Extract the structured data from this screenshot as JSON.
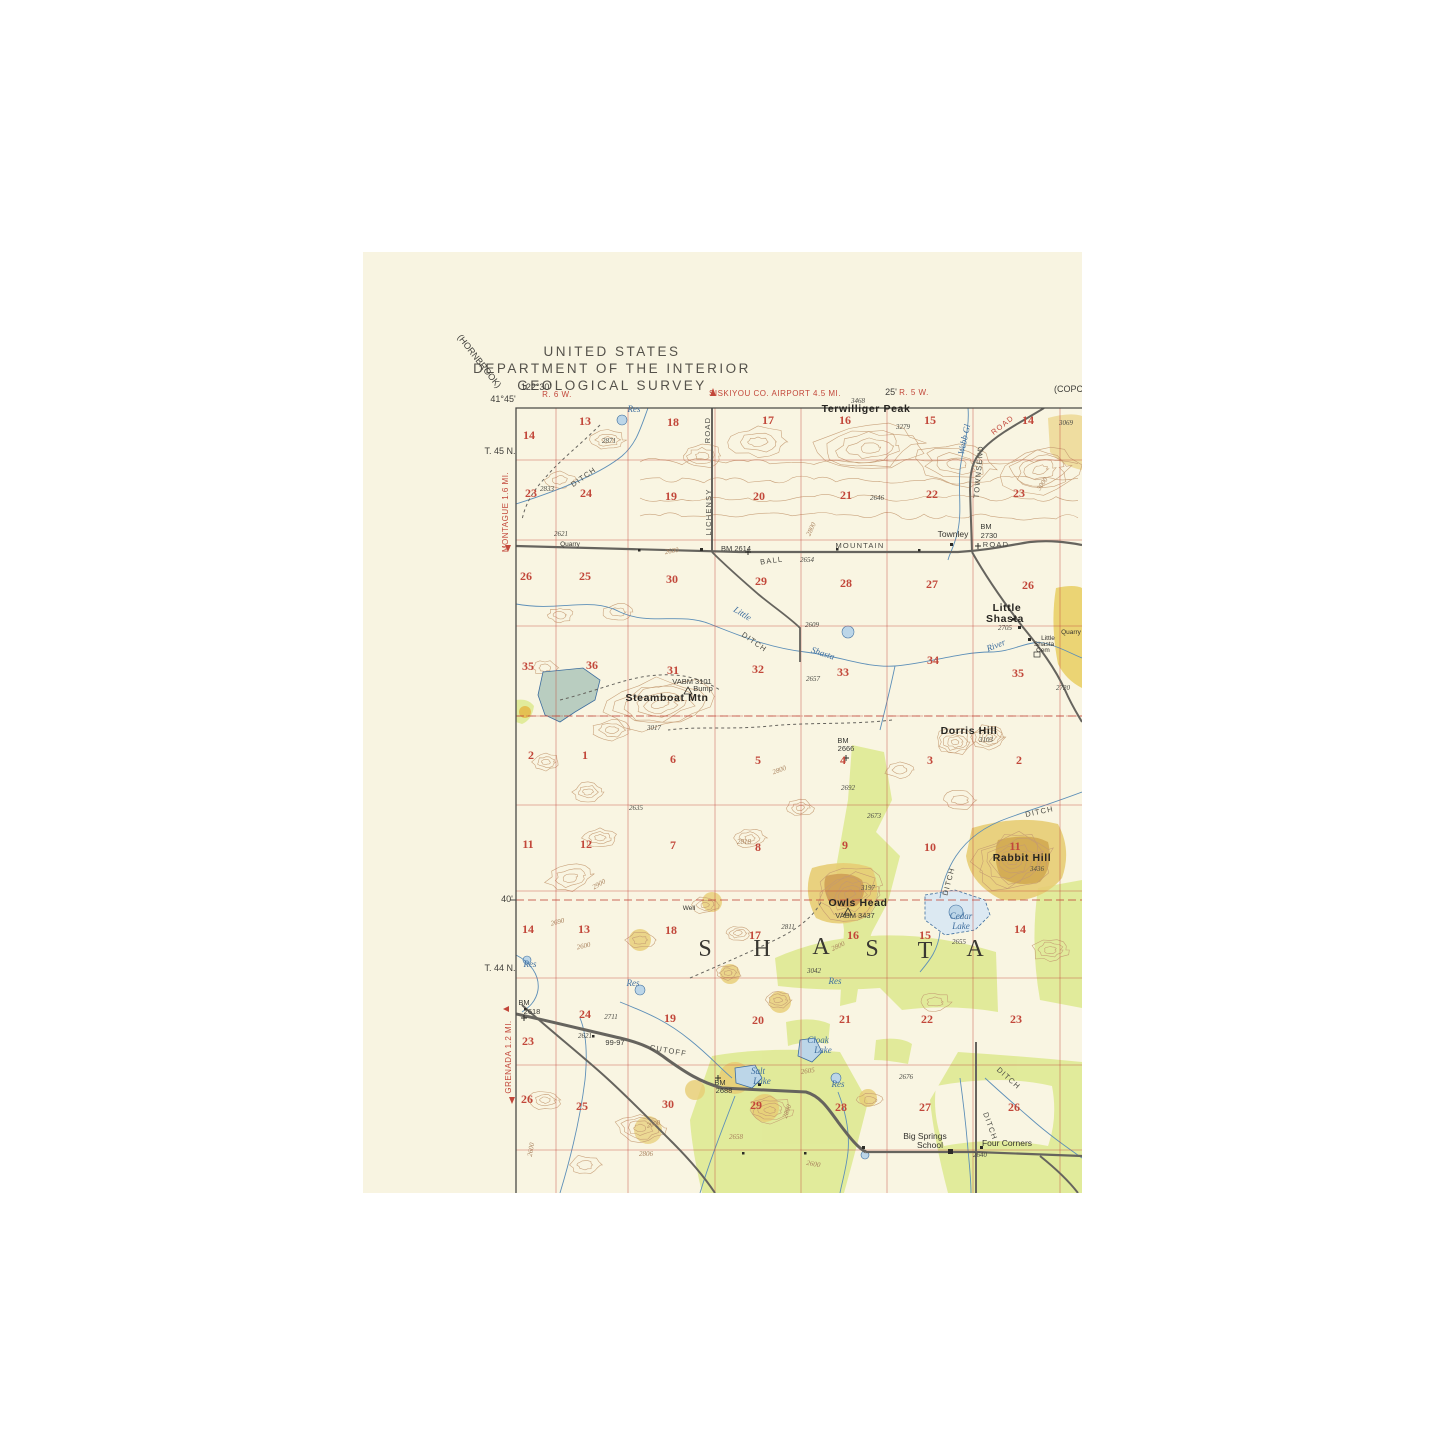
{
  "header": {
    "line1": "UNITED STATES",
    "line2": "DEPARTMENT OF THE INTERIOR",
    "line3": "GEOLOGICAL SURVEY"
  },
  "colors": {
    "paper": "#f8f4e1",
    "map_ground": "#f9f5e2",
    "grid_red": "#c2473a",
    "water_blue": "#3d6d9e",
    "water_fill": "#c9dfea",
    "reservoir_fill": "#b9cdc0",
    "contour_brown": "#c49a72",
    "vegetation_green": "#dde98e",
    "hill_tan": "#e7cd74",
    "hill_tan_dark": "#d2a951",
    "road_gray": "#66645e",
    "text_black": "#35332e"
  },
  "map": {
    "labels": [
      {
        "t": "(HORNBROOK)",
        "x": 477,
        "y": 363,
        "c": "e",
        "r": 52
      },
      {
        "t": "122°30'",
        "x": 536,
        "y": 390,
        "c": "e"
      },
      {
        "t": "41°45'",
        "x": 503,
        "y": 402,
        "c": "e"
      },
      {
        "t": "R. 6 W.",
        "x": 557,
        "y": 397,
        "c": "er"
      },
      {
        "t": "SISKIYOU CO. AIRPORT 4.5 MI.",
        "x": 775,
        "y": 396,
        "c": "er"
      },
      {
        "t": "25'",
        "x": 891,
        "y": 395,
        "c": "e"
      },
      {
        "t": "R. 5 W.",
        "x": 914,
        "y": 395,
        "c": "er"
      },
      {
        "t": "(COPCO",
        "x": 1072,
        "y": 392,
        "c": "e"
      },
      {
        "t": "T. 45 N.",
        "x": 500,
        "y": 454,
        "c": "e"
      },
      {
        "t": "MONTAGUE 1.6 MI.",
        "x": 508,
        "y": 512,
        "c": "er",
        "r": -90
      },
      {
        "t": "40'",
        "x": 507,
        "y": 902,
        "c": "e"
      },
      {
        "t": "T. 44 N.",
        "x": 500,
        "y": 971,
        "c": "e"
      },
      {
        "t": "GRENADA 1.2 MI.",
        "x": 511,
        "y": 1057,
        "c": "er",
        "r": -90
      },
      {
        "t": "14",
        "x": 529,
        "y": 439,
        "c": "s"
      },
      {
        "t": "13",
        "x": 585,
        "y": 425,
        "c": "s"
      },
      {
        "t": "18",
        "x": 673,
        "y": 426,
        "c": "s"
      },
      {
        "t": "17",
        "x": 768,
        "y": 424,
        "c": "s"
      },
      {
        "t": "16",
        "x": 845,
        "y": 424,
        "c": "s"
      },
      {
        "t": "15",
        "x": 930,
        "y": 424,
        "c": "s"
      },
      {
        "t": "14",
        "x": 1028,
        "y": 424,
        "c": "s"
      },
      {
        "t": "23",
        "x": 531,
        "y": 497,
        "c": "s"
      },
      {
        "t": "24",
        "x": 586,
        "y": 497,
        "c": "s"
      },
      {
        "t": "19",
        "x": 671,
        "y": 500,
        "c": "s"
      },
      {
        "t": "20",
        "x": 759,
        "y": 500,
        "c": "s"
      },
      {
        "t": "21",
        "x": 846,
        "y": 499,
        "c": "s"
      },
      {
        "t": "22",
        "x": 932,
        "y": 498,
        "c": "s"
      },
      {
        "t": "23",
        "x": 1019,
        "y": 497,
        "c": "s"
      },
      {
        "t": "26",
        "x": 526,
        "y": 580,
        "c": "s"
      },
      {
        "t": "25",
        "x": 585,
        "y": 580,
        "c": "s"
      },
      {
        "t": "30",
        "x": 672,
        "y": 583,
        "c": "s"
      },
      {
        "t": "29",
        "x": 761,
        "y": 585,
        "c": "s"
      },
      {
        "t": "28",
        "x": 846,
        "y": 587,
        "c": "s"
      },
      {
        "t": "27",
        "x": 932,
        "y": 588,
        "c": "s"
      },
      {
        "t": "26",
        "x": 1028,
        "y": 589,
        "c": "s"
      },
      {
        "t": "35",
        "x": 528,
        "y": 670,
        "c": "s"
      },
      {
        "t": "36",
        "x": 592,
        "y": 669,
        "c": "s"
      },
      {
        "t": "31",
        "x": 673,
        "y": 674,
        "c": "s"
      },
      {
        "t": "32",
        "x": 758,
        "y": 673,
        "c": "s"
      },
      {
        "t": "33",
        "x": 843,
        "y": 676,
        "c": "s"
      },
      {
        "t": "34",
        "x": 933,
        "y": 664,
        "c": "s"
      },
      {
        "t": "35",
        "x": 1018,
        "y": 677,
        "c": "s"
      },
      {
        "t": "2",
        "x": 531,
        "y": 759,
        "c": "s"
      },
      {
        "t": "1",
        "x": 585,
        "y": 759,
        "c": "s"
      },
      {
        "t": "6",
        "x": 673,
        "y": 763,
        "c": "s"
      },
      {
        "t": "5",
        "x": 758,
        "y": 764,
        "c": "s"
      },
      {
        "t": "4",
        "x": 843,
        "y": 764,
        "c": "s"
      },
      {
        "t": "3",
        "x": 930,
        "y": 764,
        "c": "s"
      },
      {
        "t": "2",
        "x": 1019,
        "y": 764,
        "c": "s"
      },
      {
        "t": "11",
        "x": 528,
        "y": 848,
        "c": "s"
      },
      {
        "t": "12",
        "x": 586,
        "y": 848,
        "c": "s"
      },
      {
        "t": "7",
        "x": 673,
        "y": 849,
        "c": "s"
      },
      {
        "t": "8",
        "x": 758,
        "y": 851,
        "c": "s"
      },
      {
        "t": "9",
        "x": 845,
        "y": 849,
        "c": "s"
      },
      {
        "t": "10",
        "x": 930,
        "y": 851,
        "c": "s"
      },
      {
        "t": "11",
        "x": 1015,
        "y": 850,
        "c": "s"
      },
      {
        "t": "14",
        "x": 528,
        "y": 933,
        "c": "s"
      },
      {
        "t": "13",
        "x": 584,
        "y": 933,
        "c": "s"
      },
      {
        "t": "18",
        "x": 671,
        "y": 934,
        "c": "s"
      },
      {
        "t": "17",
        "x": 755,
        "y": 939,
        "c": "s"
      },
      {
        "t": "16",
        "x": 853,
        "y": 939,
        "c": "s"
      },
      {
        "t": "15",
        "x": 925,
        "y": 939,
        "c": "s"
      },
      {
        "t": "14",
        "x": 1020,
        "y": 933,
        "c": "s"
      },
      {
        "t": "23",
        "x": 528,
        "y": 1045,
        "c": "s"
      },
      {
        "t": "24",
        "x": 585,
        "y": 1018,
        "c": "s"
      },
      {
        "t": "19",
        "x": 670,
        "y": 1022,
        "c": "s"
      },
      {
        "t": "20",
        "x": 758,
        "y": 1024,
        "c": "s"
      },
      {
        "t": "21",
        "x": 845,
        "y": 1023,
        "c": "s"
      },
      {
        "t": "22",
        "x": 927,
        "y": 1023,
        "c": "s"
      },
      {
        "t": "23",
        "x": 1016,
        "y": 1023,
        "c": "s"
      },
      {
        "t": "26",
        "x": 527,
        "y": 1103,
        "c": "s"
      },
      {
        "t": "25",
        "x": 582,
        "y": 1110,
        "c": "s"
      },
      {
        "t": "30",
        "x": 668,
        "y": 1108,
        "c": "s"
      },
      {
        "t": "29",
        "x": 756,
        "y": 1109,
        "c": "s"
      },
      {
        "t": "28",
        "x": 841,
        "y": 1111,
        "c": "s"
      },
      {
        "t": "27",
        "x": 925,
        "y": 1111,
        "c": "s"
      },
      {
        "t": "26",
        "x": 1014,
        "y": 1111,
        "c": "s"
      },
      {
        "t": "Terwilliger Peak",
        "x": 866,
        "y": 412,
        "c": "pb"
      },
      {
        "t": "3468",
        "x": 858,
        "y": 403,
        "c": "vi"
      },
      {
        "t": "3279",
        "x": 903,
        "y": 429,
        "c": "vi"
      },
      {
        "t": "3069",
        "x": 1066,
        "y": 425,
        "c": "vi"
      },
      {
        "t": "Res",
        "x": 634,
        "y": 412,
        "c": "w"
      },
      {
        "t": "2871",
        "x": 609,
        "y": 443,
        "c": "vi"
      },
      {
        "t": "2833",
        "x": 547,
        "y": 491,
        "c": "vi"
      },
      {
        "t": "DITCH",
        "x": 585,
        "y": 479,
        "c": "rd",
        "r": -35
      },
      {
        "t": "2646",
        "x": 877,
        "y": 500,
        "c": "vi"
      },
      {
        "t": "Townley",
        "x": 953,
        "y": 537,
        "c": "p"
      },
      {
        "t": "BM",
        "x": 986,
        "y": 529,
        "c": "v"
      },
      {
        "t": "2730",
        "x": 989,
        "y": 538,
        "c": "v"
      },
      {
        "t": "BM 2614",
        "x": 736,
        "y": 551,
        "c": "v"
      },
      {
        "t": "BALL",
        "x": 772,
        "y": 563,
        "c": "rd",
        "r": -8
      },
      {
        "t": "MOUNTAIN",
        "x": 860,
        "y": 548,
        "c": "rd"
      },
      {
        "t": "ROAD",
        "x": 996,
        "y": 547,
        "c": "rd"
      },
      {
        "t": "2654",
        "x": 807,
        "y": 562,
        "c": "vi"
      },
      {
        "t": "2621",
        "x": 561,
        "y": 536,
        "c": "vi"
      },
      {
        "t": "Quarry",
        "x": 570,
        "y": 546,
        "c": "p6"
      },
      {
        "t": "2600",
        "x": 672,
        "y": 553,
        "c": "c",
        "r": -10
      },
      {
        "t": "LICHENSY",
        "x": 711,
        "y": 512,
        "c": "rd",
        "r": -90
      },
      {
        "t": "ROAD",
        "x": 710,
        "y": 430,
        "c": "rd",
        "r": -90
      },
      {
        "t": "Webb Gl",
        "x": 967,
        "y": 440,
        "c": "w",
        "r": -78
      },
      {
        "t": "TOWNSEND",
        "x": 981,
        "y": 472,
        "c": "rd",
        "r": -85
      },
      {
        "t": "ROAD",
        "x": 1004,
        "y": 427,
        "c": "rdr",
        "r": -38
      },
      {
        "t": "2800",
        "x": 813,
        "y": 530,
        "c": "c",
        "r": -65
      },
      {
        "t": "3000",
        "x": 1044,
        "y": 485,
        "c": "c",
        "r": -55
      },
      {
        "t": "Little",
        "x": 741,
        "y": 616,
        "c": "w",
        "r": 32
      },
      {
        "t": "DITCH",
        "x": 753,
        "y": 644,
        "c": "rd",
        "r": 35
      },
      {
        "t": "Shasta",
        "x": 822,
        "y": 656,
        "c": "w",
        "r": 18
      },
      {
        "t": "River",
        "x": 997,
        "y": 648,
        "c": "w",
        "r": -22
      },
      {
        "t": "2609",
        "x": 812,
        "y": 627,
        "c": "vi"
      },
      {
        "t": "2657",
        "x": 813,
        "y": 681,
        "c": "vi"
      },
      {
        "t": "Little",
        "x": 1007,
        "y": 611,
        "c": "pb"
      },
      {
        "t": "Shasta",
        "x": 1005,
        "y": 622,
        "c": "pb"
      },
      {
        "t": "2705",
        "x": 1005,
        "y": 630,
        "c": "vi"
      },
      {
        "t": "Little",
        "x": 1048,
        "y": 640,
        "c": "p6"
      },
      {
        "t": "Shasta",
        "x": 1044,
        "y": 646,
        "c": "p6"
      },
      {
        "t": "Cem",
        "x": 1043,
        "y": 652,
        "c": "p6"
      },
      {
        "t": "Quarry",
        "x": 1071,
        "y": 634,
        "c": "p6"
      },
      {
        "t": "2720",
        "x": 1063,
        "y": 690,
        "c": "vi"
      },
      {
        "t": "Steamboat  Mtn",
        "x": 667,
        "y": 701,
        "c": "pb"
      },
      {
        "t": "VABM  3101",
        "x": 692,
        "y": 684,
        "c": "v"
      },
      {
        "t": "Bump",
        "x": 703,
        "y": 691,
        "c": "v"
      },
      {
        "t": "3017",
        "x": 654,
        "y": 730,
        "c": "vi"
      },
      {
        "t": "Dorris Hill",
        "x": 969,
        "y": 734,
        "c": "pb"
      },
      {
        "t": "3103",
        "x": 986,
        "y": 742,
        "c": "vi"
      },
      {
        "t": "BM",
        "x": 843,
        "y": 743,
        "c": "v"
      },
      {
        "t": "2666",
        "x": 846,
        "y": 751,
        "c": "v"
      },
      {
        "t": "2692",
        "x": 848,
        "y": 790,
        "c": "vi"
      },
      {
        "t": "2673",
        "x": 874,
        "y": 818,
        "c": "vi"
      },
      {
        "t": "2800",
        "x": 780,
        "y": 772,
        "c": "c",
        "r": -20
      },
      {
        "t": "2818",
        "x": 744,
        "y": 844,
        "c": "c"
      },
      {
        "t": "2635",
        "x": 636,
        "y": 810,
        "c": "vi"
      },
      {
        "t": "2900",
        "x": 600,
        "y": 886,
        "c": "c",
        "r": -30
      },
      {
        "t": "DITCH",
        "x": 1040,
        "y": 814,
        "c": "rd",
        "r": -12
      },
      {
        "t": "DITCH",
        "x": 951,
        "y": 882,
        "c": "rd",
        "r": -75
      },
      {
        "t": "Rabbit  Hill",
        "x": 1022,
        "y": 861,
        "c": "pb"
      },
      {
        "t": "3436",
        "x": 1037,
        "y": 871,
        "c": "vi"
      },
      {
        "t": "Owls  Head",
        "x": 858,
        "y": 906,
        "c": "pb"
      },
      {
        "t": "VABM  3437",
        "x": 855,
        "y": 918,
        "c": "v"
      },
      {
        "t": "3197",
        "x": 868,
        "y": 890,
        "c": "vi"
      },
      {
        "t": "2800",
        "x": 839,
        "y": 948,
        "c": "c",
        "r": -25
      },
      {
        "t": "Cedar",
        "x": 961,
        "y": 919,
        "c": "w"
      },
      {
        "t": "Lake",
        "x": 961,
        "y": 929,
        "c": "w"
      },
      {
        "t": "2655",
        "x": 959,
        "y": 944,
        "c": "vi"
      },
      {
        "t": "2690",
        "x": 558,
        "y": 924,
        "c": "c",
        "r": -15
      },
      {
        "t": "2600",
        "x": 584,
        "y": 948,
        "c": "c",
        "r": -12
      },
      {
        "t": "Well",
        "x": 689,
        "y": 910,
        "c": "p6"
      },
      {
        "t": "2811",
        "x": 788,
        "y": 929,
        "c": "vi"
      },
      {
        "t": "3042",
        "x": 814,
        "y": 973,
        "c": "vi"
      },
      {
        "t": "Res",
        "x": 530,
        "y": 967,
        "c": "w"
      },
      {
        "t": "Res",
        "x": 633,
        "y": 986,
        "c": "w"
      },
      {
        "t": "Res",
        "x": 835,
        "y": 984,
        "c": "w"
      },
      {
        "t": "S",
        "x": 706,
        "y": 956,
        "c": "big"
      },
      {
        "t": "H",
        "x": 763,
        "y": 956,
        "c": "big"
      },
      {
        "t": "A",
        "x": 822,
        "y": 954,
        "c": "big"
      },
      {
        "t": "S",
        "x": 873,
        "y": 956,
        "c": "big"
      },
      {
        "t": "T",
        "x": 926,
        "y": 958,
        "c": "big"
      },
      {
        "t": "A",
        "x": 976,
        "y": 956,
        "c": "big"
      },
      {
        "t": "BM",
        "x": 524,
        "y": 1005,
        "c": "v"
      },
      {
        "t": "2618",
        "x": 532,
        "y": 1014,
        "c": "v"
      },
      {
        "t": "2711",
        "x": 611,
        "y": 1019,
        "c": "vi"
      },
      {
        "t": "2621",
        "x": 585,
        "y": 1038,
        "c": "vi"
      },
      {
        "t": "99-97",
        "x": 615,
        "y": 1045,
        "c": "v"
      },
      {
        "t": "CUTOFF",
        "x": 668,
        "y": 1053,
        "c": "rd",
        "r": 10
      },
      {
        "t": "Cloak",
        "x": 818,
        "y": 1043,
        "c": "w"
      },
      {
        "t": "Lake",
        "x": 823,
        "y": 1053,
        "c": "w"
      },
      {
        "t": "Salt",
        "x": 758,
        "y": 1074,
        "c": "w"
      },
      {
        "t": "Lake",
        "x": 762,
        "y": 1084,
        "c": "w"
      },
      {
        "t": "BM",
        "x": 720,
        "y": 1085,
        "c": "v"
      },
      {
        "t": "2688",
        "x": 724,
        "y": 1093,
        "c": "v"
      },
      {
        "t": "2605",
        "x": 808,
        "y": 1073,
        "c": "c",
        "r": -8
      },
      {
        "t": "2676",
        "x": 906,
        "y": 1079,
        "c": "vi"
      },
      {
        "t": "2658",
        "x": 736,
        "y": 1139,
        "c": "c"
      },
      {
        "t": "2806",
        "x": 646,
        "y": 1156,
        "c": "c"
      },
      {
        "t": "2600",
        "x": 654,
        "y": 1126,
        "c": "c",
        "r": -15
      },
      {
        "t": "2600",
        "x": 533,
        "y": 1150,
        "c": "c",
        "r": -80
      },
      {
        "t": "Res",
        "x": 838,
        "y": 1087,
        "c": "w"
      },
      {
        "t": "2800",
        "x": 789,
        "y": 1112,
        "c": "c",
        "r": -70
      },
      {
        "t": "Big Springs",
        "x": 925,
        "y": 1139,
        "c": "p"
      },
      {
        "t": "School",
        "x": 930,
        "y": 1148,
        "c": "p"
      },
      {
        "t": "Four Corners",
        "x": 1007,
        "y": 1146,
        "c": "p"
      },
      {
        "t": "2640",
        "x": 980,
        "y": 1157,
        "c": "vi"
      },
      {
        "t": "DITCH",
        "x": 1007,
        "y": 1080,
        "c": "rd",
        "r": 42
      },
      {
        "t": "DITCH",
        "x": 988,
        "y": 1127,
        "c": "rd",
        "r": 70
      },
      {
        "t": "2600",
        "x": 813,
        "y": 1166,
        "c": "c",
        "r": 10
      }
    ]
  }
}
